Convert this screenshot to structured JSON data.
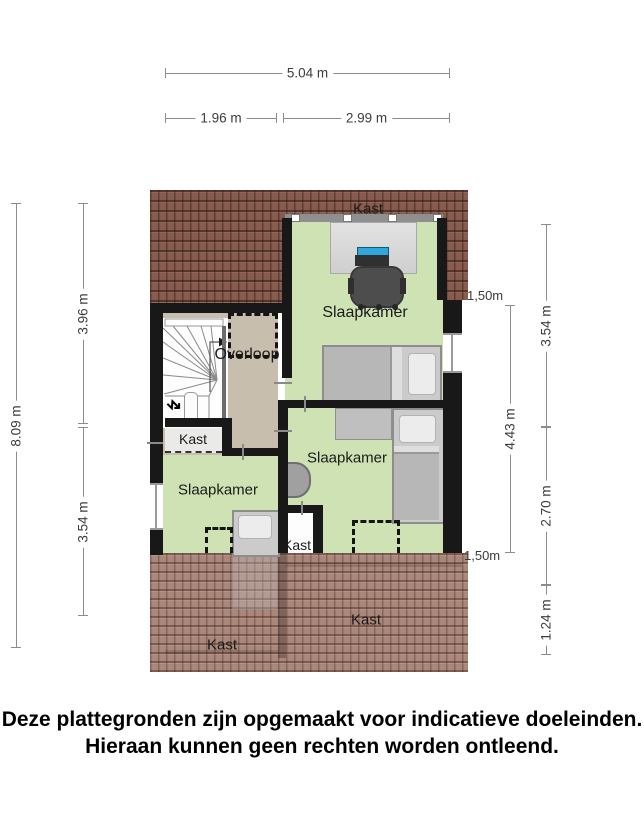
{
  "plan": {
    "labels": {
      "kast_top": "Kast",
      "slaapkamer_top": "Slaapkamer",
      "overloop": "Overloop",
      "kast_left": "Kast",
      "slaapkamer_left": "Slaapkamer",
      "slaapkamer_mid": "Slaapkamer",
      "kast_small": "Kast",
      "kast_roof_left": "Kast",
      "kast_roof_right": "Kast"
    },
    "colors": {
      "room_floor": "#cfe2b4",
      "landing_floor": "#c8bead",
      "closet_floor": "#eaeae8",
      "roof_top": "#875c4e",
      "roof_bottom": "#aa877b",
      "wall": "#181818"
    },
    "icons": {
      "stair_direction": "↯"
    }
  },
  "dimensions": {
    "top": {
      "total": "5.04 m",
      "left": "1.96 m",
      "right": "2.99 m"
    },
    "left": {
      "total": "8.09 m",
      "upper": "3.96 m",
      "lower": "3.54 m"
    },
    "right": {
      "upper": "3.54 m",
      "middle": "2.70 m",
      "lower": "1.24 m",
      "inner": "4.43 m",
      "headroom_upper": "1,50m",
      "headroom_lower": "1,50m"
    }
  },
  "disclaimer": {
    "line1": "Deze plattegronden zijn opgemaakt voor indicatieve doeleinden.",
    "line2": "Hieraan kunnen geen rechten worden ontleend."
  }
}
